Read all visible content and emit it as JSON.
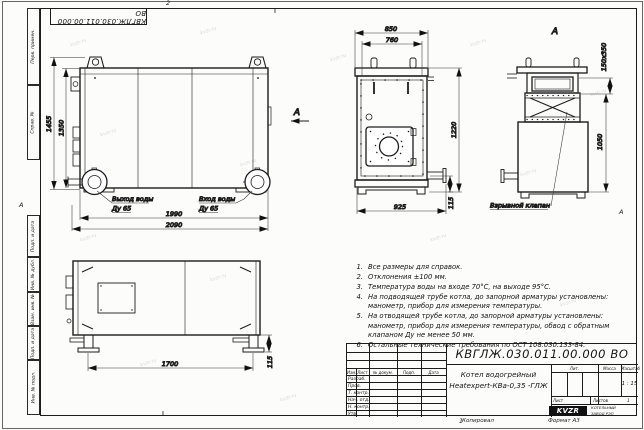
{
  "sheet": {
    "format_label": "Формат А3",
    "copied_label": "Копировал",
    "zone_top": "2",
    "zone_bottom": "1",
    "zone_left": "А",
    "zone_right": "А",
    "watermark": "kvzr.ru"
  },
  "frame_columns": {
    "perv_primen": "Перв. примен.",
    "sprav_no": "Справ. №",
    "podp_data1": "Подп. и дата",
    "inv_dubl": "Инв. № дубл.",
    "vzam_inv": "Взам. инв. №",
    "podp_data2": "Подп. и дата",
    "inv_podl": "Инв. № подл."
  },
  "views": {
    "front": {
      "h_outer": "1455",
      "h_inner": "1350",
      "w_inner": "1990",
      "w_outer": "2090",
      "outlet_line1": "Выход воды",
      "outlet_line2": "Ду 65",
      "inlet_line1": "Вход воды",
      "inlet_line2": "Ду 65",
      "arrow_label": "А"
    },
    "side": {
      "d850": "850",
      "d760": "760",
      "d1220": "1220",
      "d925": "925",
      "d115": "115"
    },
    "rear": {
      "title": "А",
      "flue": "150х350",
      "d1050": "1050",
      "valve_label": "Взрывной клапан"
    },
    "top": {
      "d1700": "1700",
      "d115": "115"
    }
  },
  "notes": {
    "items": [
      {
        "num": "1.",
        "text": "Все размеры для справок."
      },
      {
        "num": "2.",
        "text": "Отклонения ±100 мм."
      },
      {
        "num": "3.",
        "text": "Температура воды на входе 70°С, на выходе 95°С."
      },
      {
        "num": "4.",
        "text": "На подводящей трубе котла, до запорной арматуры установлены: манометр, прибор для измерения температуры."
      },
      {
        "num": "5.",
        "text": "На отводящей трубе котла, до запорной арматуры установлены: манометр, прибор для измерения температуры, обвод с обратным клапаном Ду не менее 50 мм."
      },
      {
        "num": "6.",
        "text": "Остальные технические требования по ОСТ 108.030.133-84."
      }
    ]
  },
  "title_block": {
    "doc_number": "КВГЛЖ.030.011.00.000 ВО",
    "product_line1": "Котел водогрейный",
    "product_line2": "Heatexpert-КВа-0,35 -ГЛЖ",
    "col_izm": "Изм.",
    "col_list": "Лист",
    "col_doc": "№ докум.",
    "col_podp": "Подп.",
    "col_data": "Дата",
    "rows": [
      "Разраб.",
      "Пров.",
      "Т. контр.",
      "Нач. отд.",
      "Н. контр.",
      "Утв."
    ],
    "lit_label": "Лит.",
    "mass_label": "Масса",
    "scale_label": "Масштаб",
    "scale_value": "1 : 15",
    "sheet_label": "Лист",
    "sheets_label": "Листов",
    "sheets_value": "1",
    "logo_text": "KVZR",
    "company_line1": "КОТЕЛЬНЫЙ",
    "company_line2": "ЗАВОД РЭП"
  }
}
